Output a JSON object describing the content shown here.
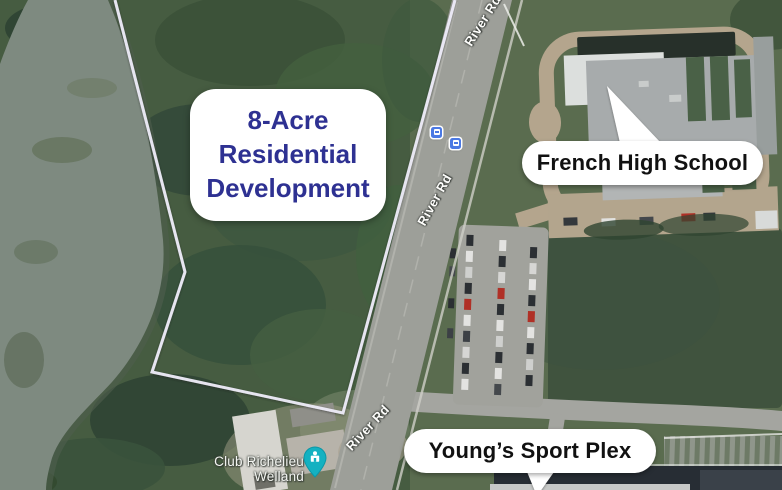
{
  "annotations": {
    "parcel": {
      "lines": [
        "8-Acre",
        "Residential",
        "Development"
      ],
      "text_color": "#2e3192"
    },
    "school_callout": "French High School",
    "sportplex_callout": "Young’s Sport Plex"
  },
  "map": {
    "road_label": "River Rd",
    "poi": {
      "name": "Club Richelieu Welland",
      "pin_color": "#14b1c1",
      "pin_icon": "community-building"
    },
    "transit_stops": {
      "icon": "bus-stop",
      "count": 2,
      "color": "#4b79e4"
    }
  }
}
